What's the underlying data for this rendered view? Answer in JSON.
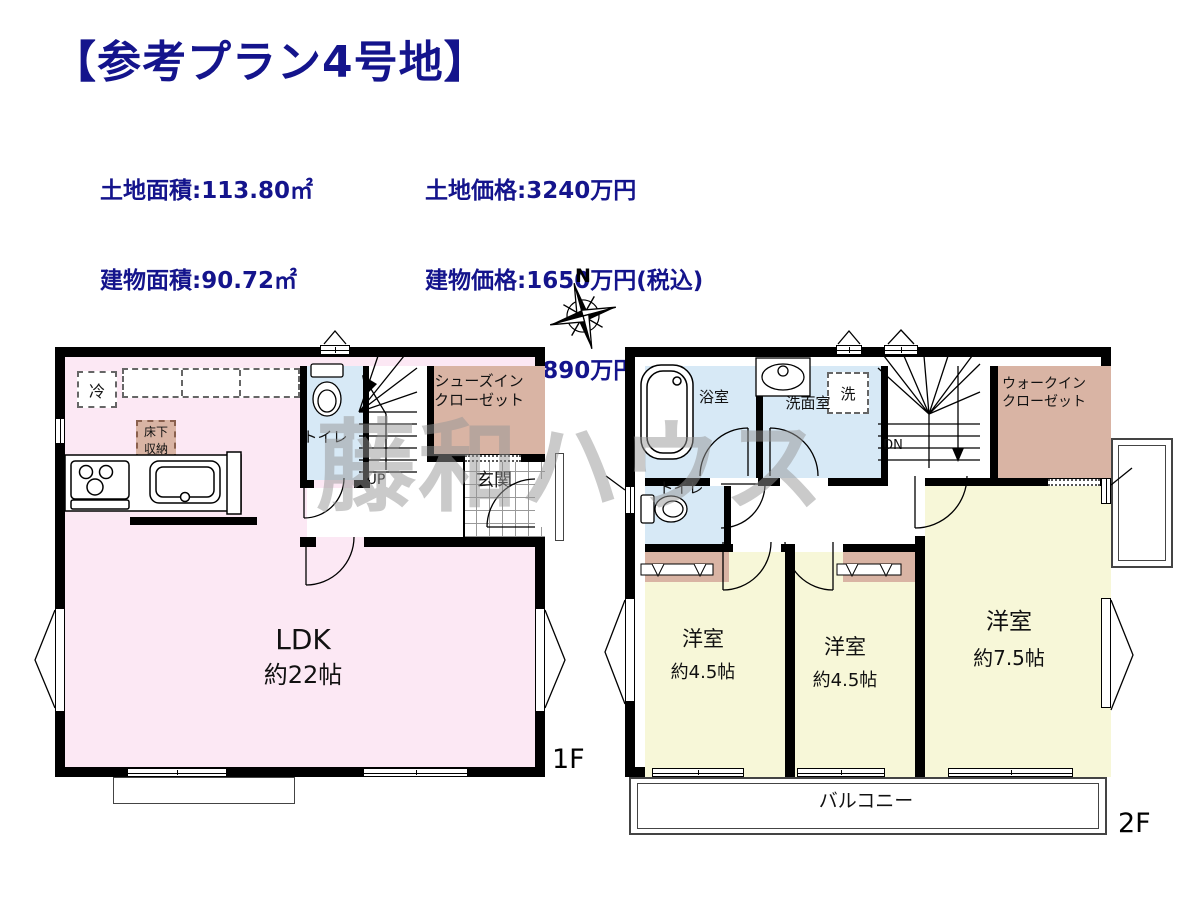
{
  "title": "【参考プラン4号地】",
  "info": {
    "left": [
      "土地面積:113.80㎡",
      "建物面積:90.72㎡",
      "1F:45.36㎡",
      "2F:45.36㎡"
    ],
    "right": [
      "土地価格:3240万円",
      "建物価格:1650万円(税込)",
      "総　　額:4890万円(税込)"
    ]
  },
  "compass": {
    "north": "N"
  },
  "watermark": "藤和ハウス",
  "floor1": {
    "label": "1F",
    "ldk": {
      "name": "LDK",
      "size": "約22帖"
    },
    "toilet": "トイレ",
    "stairs_up": "UP",
    "entrance": "玄関",
    "shoes_closet": [
      "シューズイン",
      "クローゼット"
    ],
    "fridge": "冷",
    "underfloor": [
      "床下",
      "収納"
    ]
  },
  "floor2": {
    "label": "2F",
    "bath": "浴室",
    "washroom": "洗面室",
    "laundry": "洗",
    "toilet": "トイレ",
    "stairs_down": "DN",
    "walkin_closet": [
      "ウォークイン",
      "クローゼット"
    ],
    "bedroom1": {
      "name": "洋室",
      "size": "約4.5帖"
    },
    "bedroom2": {
      "name": "洋室",
      "size": "約4.5帖"
    },
    "bedroom3": {
      "name": "洋室",
      "size": "約7.5帖"
    },
    "balcony": "バルコニー"
  },
  "colors": {
    "navy": "#14148c",
    "wall": "#000000",
    "ldk_pink": "#fce8f4",
    "wet_blue": "#d7e9f6",
    "closet_tan": "#d9b4a4",
    "bedroom_yellow": "#f7f7d8"
  }
}
